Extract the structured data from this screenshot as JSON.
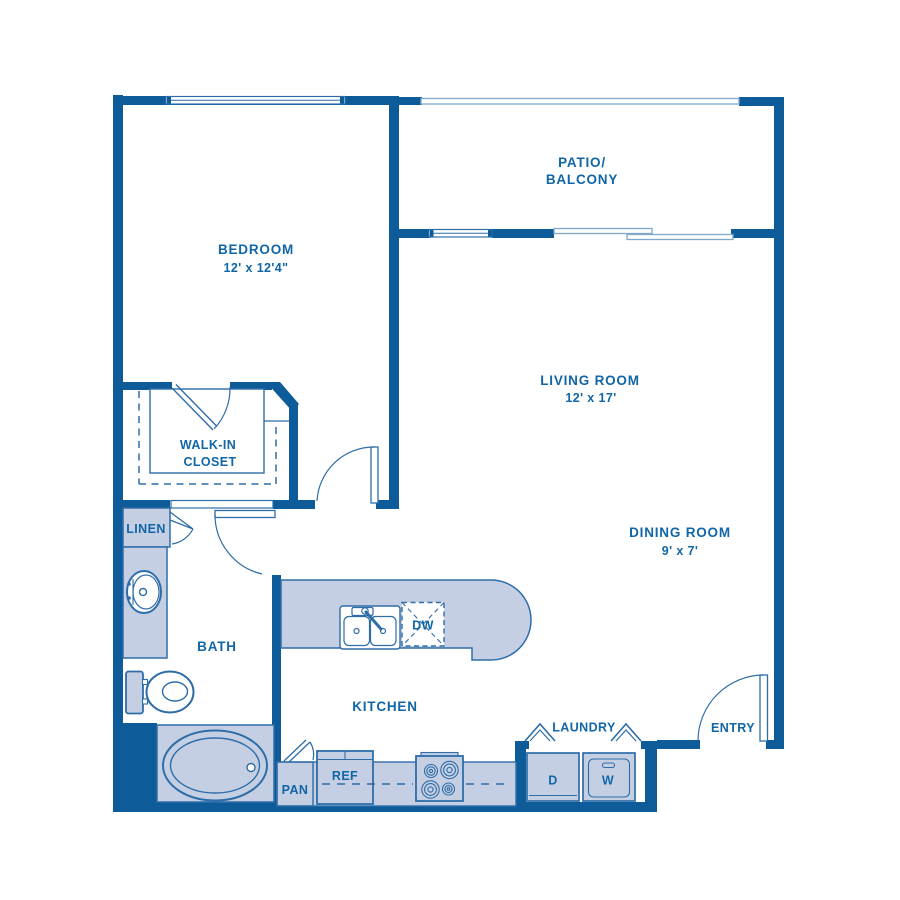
{
  "floorplan": {
    "colors": {
      "wall": "#0d5c99",
      "fill": "#c5cfe3",
      "line": "#2e6da8",
      "window": "#7fa8cc",
      "text": "#1166a7"
    },
    "rooms": {
      "bedroom": {
        "name": "BEDROOM",
        "dimensions": "12' x 12'4\""
      },
      "patio": {
        "name_line1": "PATIO/",
        "name_line2": "BALCONY"
      },
      "living": {
        "name": "LIVING ROOM",
        "dimensions": "12' x 17'"
      },
      "dining": {
        "name": "DINING ROOM",
        "dimensions": "9' x 7'"
      },
      "closet": {
        "name_line1": "WALK-IN",
        "name_line2": "CLOSET"
      },
      "linen": {
        "name": "LINEN"
      },
      "bath": {
        "name": "BATH"
      },
      "kitchen": {
        "name": "KITCHEN"
      },
      "laundry": {
        "name": "LAUNDRY"
      },
      "entry": {
        "name": "ENTRY"
      }
    },
    "fixtures": {
      "pantry": "PAN",
      "refrigerator": "REF",
      "dishwasher": "DW",
      "dryer": "D",
      "washer": "W"
    }
  }
}
